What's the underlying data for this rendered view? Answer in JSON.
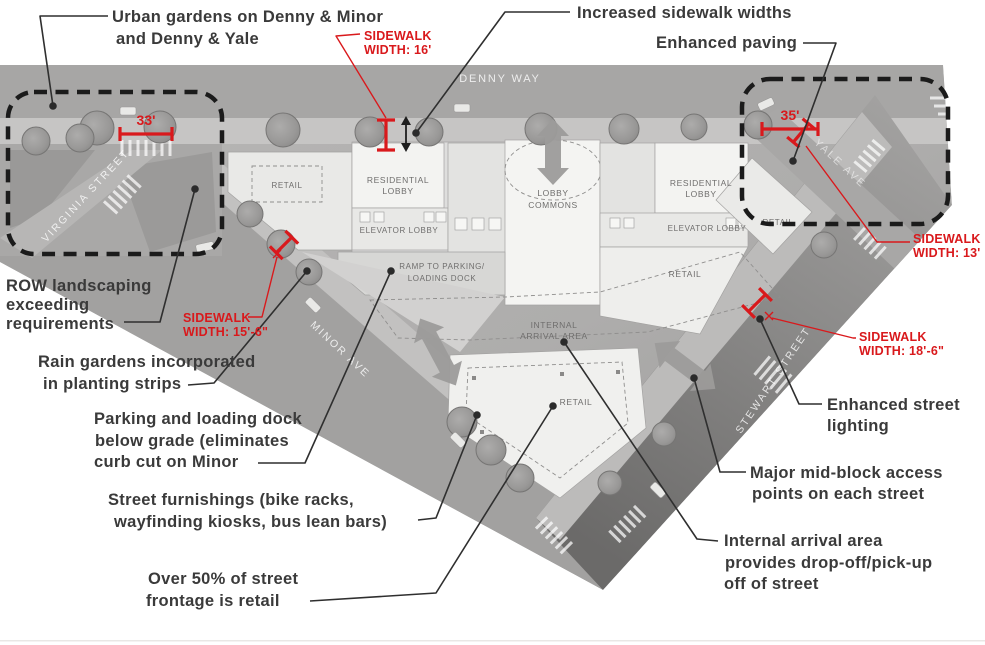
{
  "callouts": {
    "urban_gardens": [
      "Urban gardens on Denny & Minor",
      "and Denny & Yale"
    ],
    "increased_sidewalk": [
      "Increased sidewalk widths"
    ],
    "enhanced_paving": [
      "Enhanced paving"
    ],
    "row_landscaping": [
      "ROW landscaping",
      "exceeding",
      "requirements"
    ],
    "rain_gardens": [
      "Rain gardens incorporated",
      "in planting strips"
    ],
    "parking_loading": [
      "Parking and loading dock",
      "below grade (eliminates",
      "curb cut on Minor"
    ],
    "street_furnishings": [
      "Street furnishings (bike racks,",
      "wayfinding kiosks, bus lean bars)"
    ],
    "over_50_retail": [
      "Over 50% of street",
      "frontage is retail"
    ],
    "enhanced_lighting": [
      "Enhanced street",
      "lighting"
    ],
    "major_midblock": [
      "Major mid-block access",
      "points on each street"
    ],
    "internal_arrival": [
      "Internal arrival area",
      "provides drop-off/pick-up",
      "off of street"
    ]
  },
  "sidewalk_widths": {
    "denny": [
      "SIDEWALK",
      "WIDTH: 16'"
    ],
    "minor": [
      "SIDEWALK",
      "WIDTH: 15'-6\""
    ],
    "yale": [
      "SIDEWALK",
      "WIDTH: 13'"
    ],
    "stewart": [
      "SIDEWALK",
      "WIDTH: 18'-6\""
    ]
  },
  "dimensions": {
    "virginia_crossing": "33'",
    "yale_crossing": "35'"
  },
  "streets": {
    "denny": "DENNY WAY",
    "virginia": "VIRGINIA STREET",
    "minor": "MINOR AVE",
    "yale": "YALE AVE",
    "stewart": "STEWART STREET"
  },
  "plan_labels": {
    "residential_lobby": [
      "RESIDENTIAL",
      "LOBBY"
    ],
    "lobby_commons": [
      "LOBBY",
      "COMMONS"
    ],
    "elevator_lobby": "ELEVATOR LOBBY",
    "ramp": [
      "RAMP TO PARKING/",
      "LOADING DOCK"
    ],
    "retail": "RETAIL",
    "internal_arrival": [
      "INTERNAL",
      "ARRIVAL AREA"
    ]
  },
  "colors": {
    "annotation_text": "#3a3a3a",
    "annotation_red": "#d9191c",
    "dashed_highlight": "#1b1b1b",
    "arrow_gray": "#9c9b9a"
  }
}
